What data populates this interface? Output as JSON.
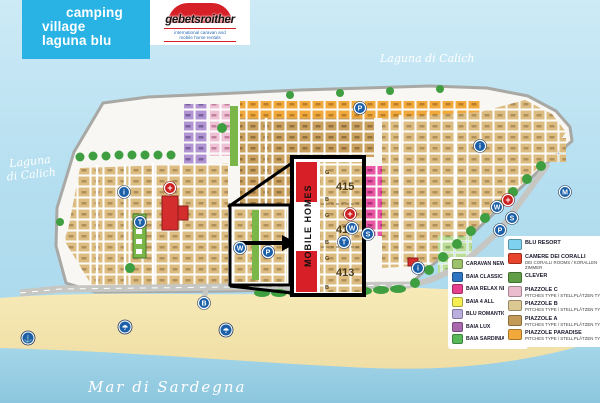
{
  "header": {
    "title_line1": "camping",
    "title_line2": "village",
    "title_line3": "laguna blu",
    "logo_name": "gebetsroither",
    "logo_tagline1": "international caravan and",
    "logo_tagline2": "mobile home rentals"
  },
  "labels": {
    "lagoon_left_line1": "Laguna",
    "lagoon_left_line2": "di Calich",
    "lagoon_top": "Laguna di Calich",
    "sea": "Mar di Sardegna"
  },
  "mobile_homes": {
    "title": "MOBILE HOMES",
    "sections": [
      {
        "number": "415",
        "top": "G",
        "bottom": "B"
      },
      {
        "number": "414",
        "top": "G",
        "bottom": "B"
      },
      {
        "number": "413",
        "top": "G",
        "bottom": "B"
      }
    ]
  },
  "legend_accommodations": {
    "items": [
      {
        "label": "CARAVAN NEW",
        "color": "#9dc26b"
      },
      {
        "label": "BAIA CLASSIC",
        "color": "#2e75c2"
      },
      {
        "label": "BAIA RELAX NEW",
        "color": "#e63f8e"
      },
      {
        "label": "BAIA 4 ALL",
        "color": "#f5ee52"
      },
      {
        "label": "BLU ROMANTIC",
        "color": "#b9aede"
      },
      {
        "label": "BAIA LUX",
        "color": "#a869ad"
      },
      {
        "label": "BAIA SARDINIA",
        "color": "#59b858"
      }
    ]
  },
  "legend_areas": {
    "items": [
      {
        "label": "BLU RESORT",
        "sub": "",
        "color": "#7fd2ef"
      },
      {
        "label": "CAMERE DEI CORALLI",
        "sub": "DEI CORALLI ROOMS / KORALLEN ZIMMER",
        "color": "#e8432c"
      },
      {
        "label": "CLEVER",
        "sub": "",
        "color": "#5f9e46"
      },
      {
        "label": "PIAZZOLE C",
        "sub": "PITCHES TYPE / STELLPLÄTZEN TYP",
        "color": "#eabccd"
      },
      {
        "label": "PIAZZOLE B",
        "sub": "PITCHES TYPE / STELLPLÄTZEN TYP",
        "color": "#dcc892"
      },
      {
        "label": "PIAZZOLE A",
        "sub": "PITCHES TYPE / STELLPLÄTZEN TYP",
        "color": "#c49a58"
      },
      {
        "label": "PIAZZOLE PARADISE",
        "sub": "PITCHES TYPE / STELLPLÄTZEN TYP",
        "color": "#f2a93b"
      }
    ]
  },
  "icons": [
    {
      "name": "info",
      "glyph": "i"
    },
    {
      "name": "phone",
      "glyph": "T"
    },
    {
      "name": "wc",
      "glyph": "W"
    },
    {
      "name": "parking",
      "glyph": "P"
    },
    {
      "name": "wc",
      "glyph": "W"
    },
    {
      "name": "shower",
      "glyph": "S"
    },
    {
      "name": "phone",
      "glyph": "T"
    },
    {
      "name": "info",
      "glyph": "i"
    },
    {
      "name": "wc",
      "glyph": "W"
    },
    {
      "name": "shower",
      "glyph": "S"
    },
    {
      "name": "parking",
      "glyph": "P"
    },
    {
      "name": "info",
      "glyph": "i"
    },
    {
      "name": "parking",
      "glyph": "P"
    },
    {
      "name": "market",
      "glyph": "M"
    },
    {
      "name": "first-aid",
      "glyph": "+"
    },
    {
      "name": "first-aid",
      "glyph": "+"
    },
    {
      "name": "first-aid",
      "glyph": "+"
    },
    {
      "name": "anchor",
      "glyph": "⚓"
    },
    {
      "name": "umbrella",
      "glyph": "☂"
    },
    {
      "name": "umbrella",
      "glyph": "☂"
    },
    {
      "name": "bus-stop",
      "glyph": "B"
    }
  ]
}
